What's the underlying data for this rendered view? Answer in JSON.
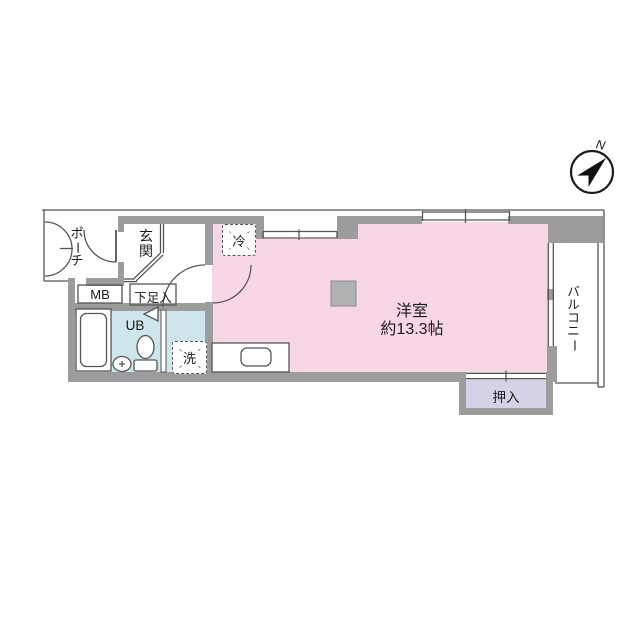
{
  "plan": {
    "compass": {
      "north": "N"
    },
    "rooms": {
      "porch": "ポーチ",
      "entrance": "玄関",
      "meter_box": "MB",
      "shoe_cabinet": "下足入",
      "unit_bath": "UB",
      "washer": "洗",
      "fridge": "冷",
      "main_room": {
        "name": "洋室",
        "size": "約13.3帖"
      },
      "closet": "押入",
      "balcony": "バルコニー"
    },
    "colors": {
      "room_pink": "#f7d7e6",
      "wet_blue": "#cde5eb",
      "closet_purple": "#d7d1e8",
      "wall_gray": "#9c9c9c",
      "pillar_gray": "#b1b1b1",
      "line_dark": "#555555"
    }
  }
}
